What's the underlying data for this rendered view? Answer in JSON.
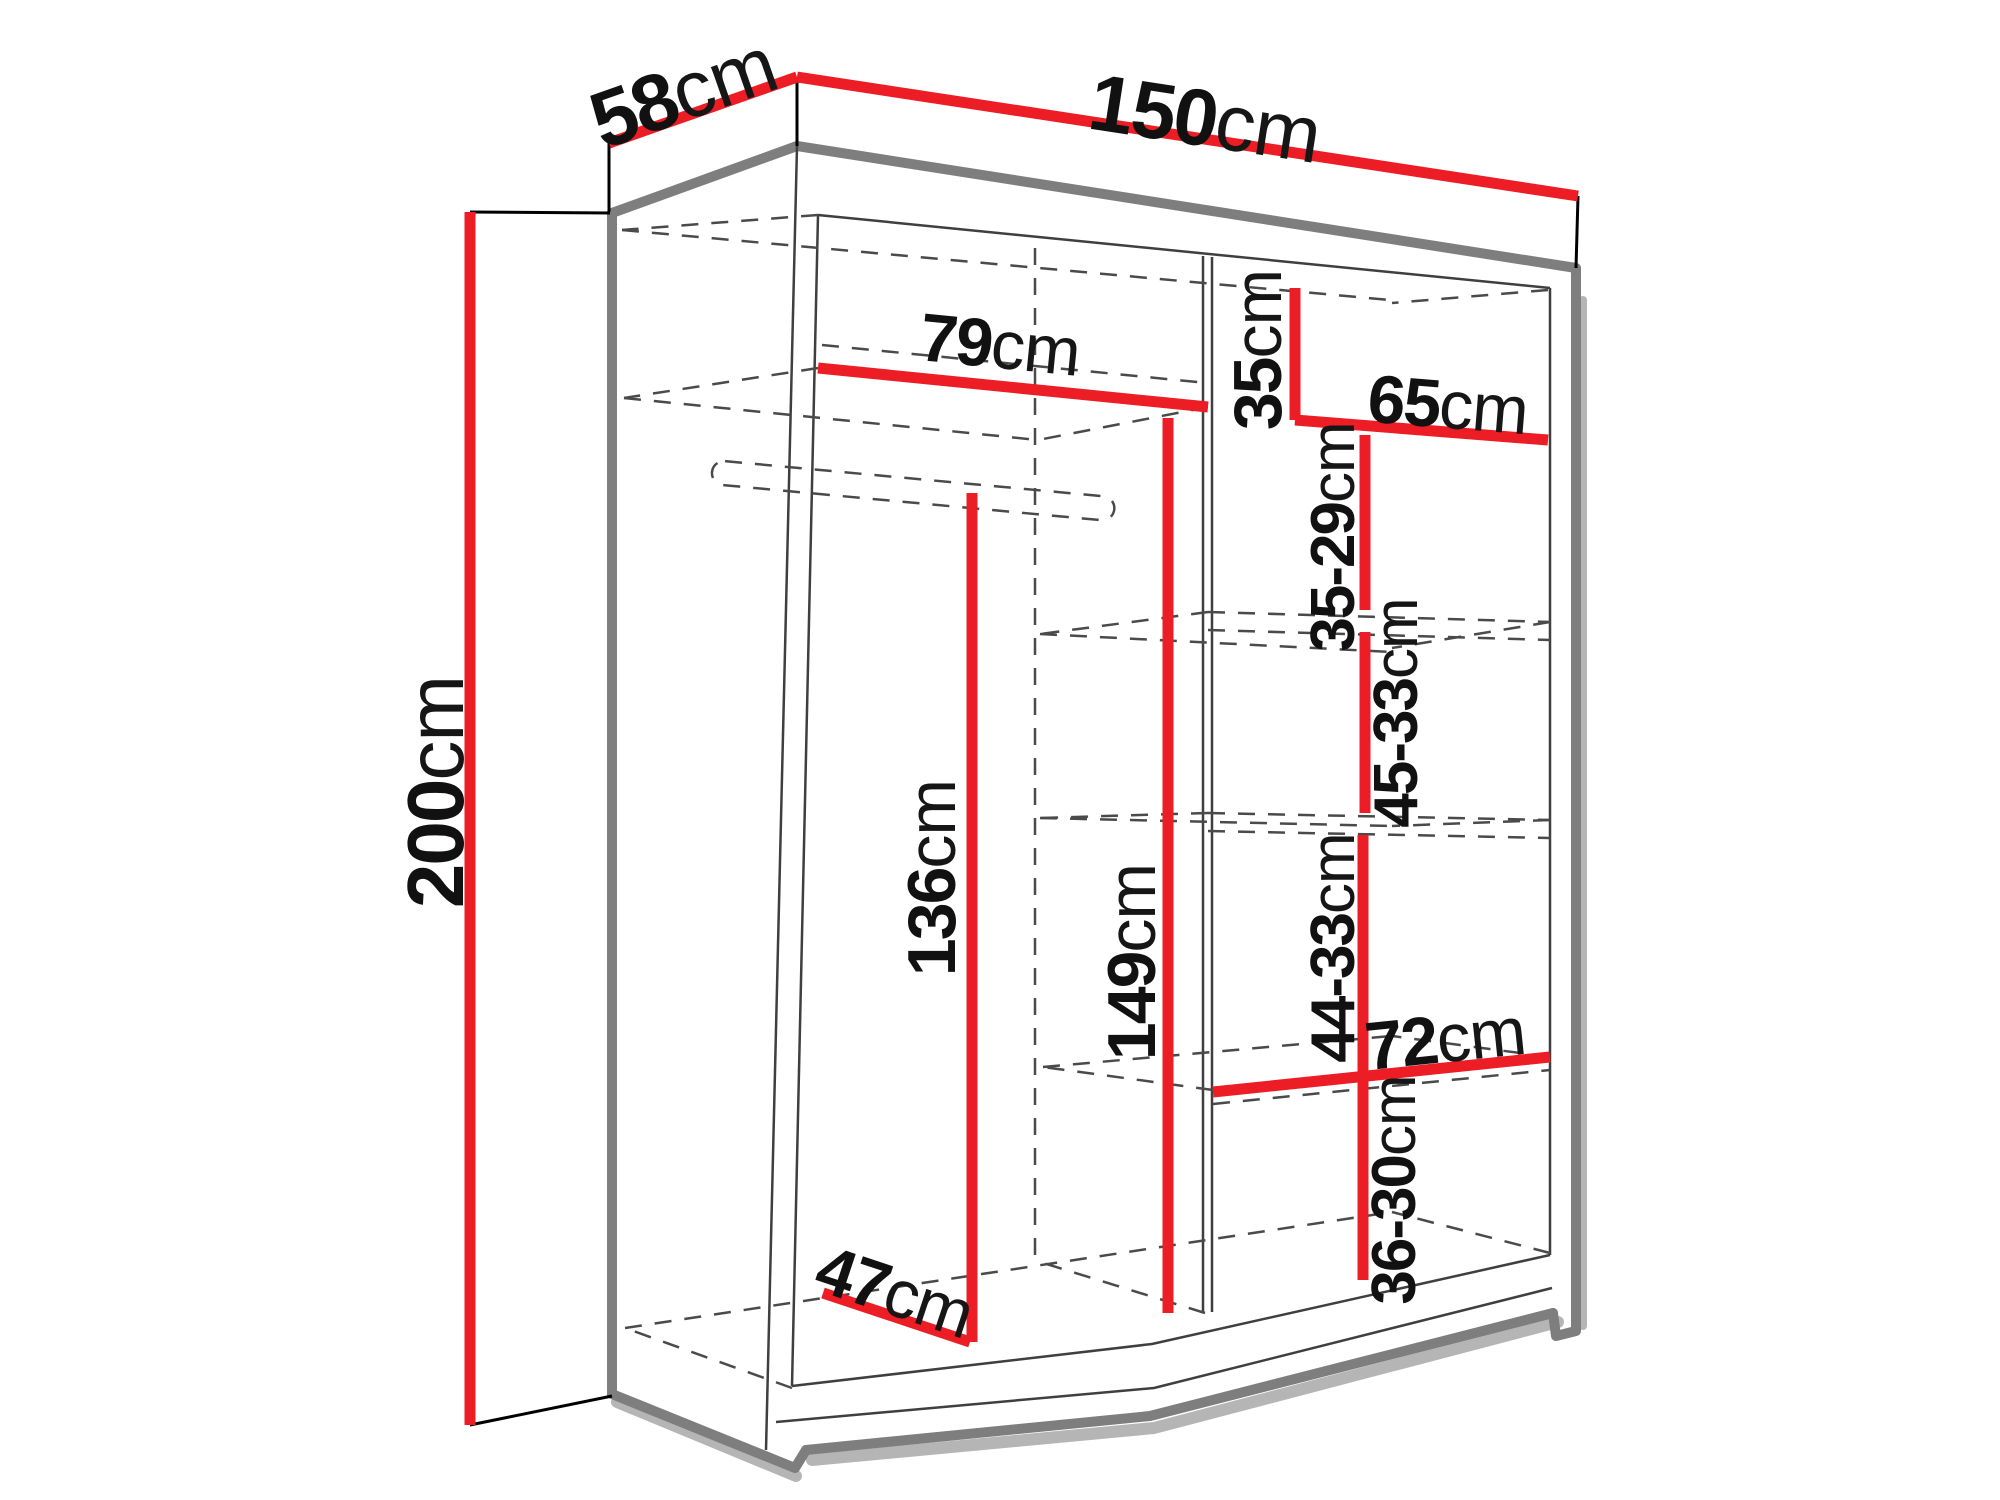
{
  "figure": {
    "type": "furniture-dimension-diagram",
    "subject": "wardrobe with internal shelves and hanging rail"
  },
  "colors": {
    "dimension_line": "#ec1d24",
    "outline_gray": "#7e7e7e",
    "shadow_gray": "#b5b5b5",
    "thin_line": "#3f3f3f",
    "dashed_line": "#4a4a4a",
    "extension_line": "#000000",
    "label_text": "#111111",
    "background": "#ffffff"
  },
  "dimensions": {
    "width": {
      "value": "150",
      "unit": "cm"
    },
    "depth": {
      "value": "58",
      "unit": "cm"
    },
    "height": {
      "value": "200",
      "unit": "cm"
    },
    "left_section_width": {
      "value": "79",
      "unit": "cm"
    },
    "top_right_shelf_height": {
      "value": "35",
      "unit": "cm"
    },
    "right_section_width": {
      "value": "65",
      "unit": "cm"
    },
    "shelf_gap_1": {
      "value": "35-29",
      "unit": "cm"
    },
    "shelf_gap_2": {
      "value": "45-33",
      "unit": "cm"
    },
    "shelf_gap_3": {
      "value": "44-33",
      "unit": "cm"
    },
    "lower_shelf_width": {
      "value": "72",
      "unit": "cm"
    },
    "shelf_gap_4": {
      "value": "36-30",
      "unit": "cm"
    },
    "hanging_height": {
      "value": "136",
      "unit": "cm"
    },
    "left_interior_height": {
      "value": "149",
      "unit": "cm"
    },
    "interior_depth": {
      "value": "47",
      "unit": "cm"
    }
  }
}
